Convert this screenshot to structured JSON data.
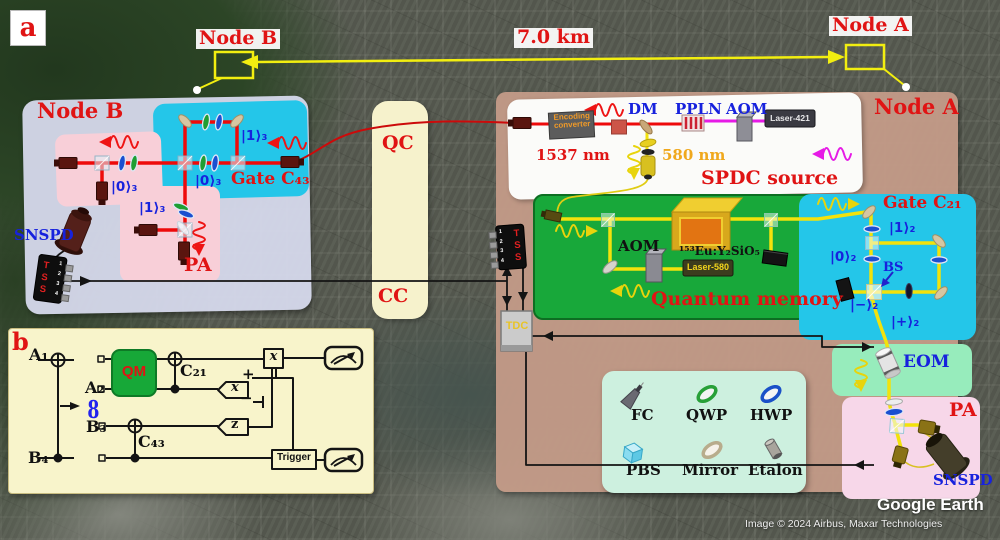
{
  "figure": {
    "panel_a": "a",
    "panel_b": "b"
  },
  "map": {
    "node_a": "Node A",
    "node_b": "Node B",
    "distance": "7.0 km",
    "watermark": "Google Earth",
    "credit": "Image © 2024 Airbus, Maxar Technologies"
  },
  "channels": {
    "qc": "QC",
    "cc": "CC"
  },
  "node_b": {
    "title": "Node B",
    "gate": "Gate C₄₃",
    "pa": "PA",
    "snspd": "SNSPD",
    "tss": "TSS",
    "tss_ports": "1\n2\n3\n4",
    "state_1_top": "|1⟩₃",
    "state_0_gate": "|0⟩₃",
    "state_0_pa": "|0⟩₃",
    "state_1_pa": "|1⟩₃"
  },
  "node_a": {
    "title": "Node A",
    "tss": "TSS",
    "tss_ports": "1\n2\n3\n4",
    "tdc": "TDC",
    "spdc": {
      "title": "SPDC source",
      "encoding_line1": "Encoding",
      "encoding_line2": "converter",
      "dm": "DM",
      "ppln": "PPLN",
      "aom": "AOM",
      "laser": "Laser-421",
      "signal_wavelength": "1537 nm",
      "pump_wavelength": "580 nm"
    },
    "memory": {
      "title": "Quantum memory",
      "aom": "AOM",
      "crystal": "¹⁵³Eu:Y₂SiO₅",
      "laser": "Laser-580"
    },
    "gate": {
      "title": "Gate C₂₁",
      "bs": "BS",
      "state_1": "|1⟩₂",
      "state_0": "|0⟩₂",
      "state_minus": "|−⟩₂",
      "state_plus": "|+⟩₂"
    },
    "eom": "EOM",
    "pa": "PA",
    "snspd": "SNSPD"
  },
  "legend": {
    "fc": "FC",
    "qwp": "QWP",
    "hwp": "HWP",
    "pbs": "PBS",
    "mirror": "Mirror",
    "etalon": "Etalon"
  },
  "circuit": {
    "label": "b",
    "q1": "A₁",
    "q2": "A₂",
    "q3": "B₃",
    "q4": "B₄",
    "qm": "QM",
    "c21": "C₂₁",
    "c43": "C₄₃",
    "x_meas": "x",
    "z_meas": "z",
    "x_corr": "x",
    "plus": "+",
    "minus": "−",
    "entangle": "8",
    "trigger": "Trigger"
  },
  "colors": {
    "label_red": "#e01414",
    "label_blue": "#1722dd",
    "beam_red": "#ee0a0a",
    "beam_yellow": "#f2e20c",
    "beam_magenta": "#e61ae6",
    "channel_bg": "#f6f2cc",
    "node_a_bg": "#c49b88",
    "node_b_bg": "#d7daee",
    "gate_cyan": "#24c6e9",
    "memory_green": "#18a83a",
    "pa_pink": "#f8cfd8",
    "eom_green": "#97ecbc",
    "pa_a_pink": "#f7d7e9",
    "legend_mint": "#cdf0df"
  }
}
